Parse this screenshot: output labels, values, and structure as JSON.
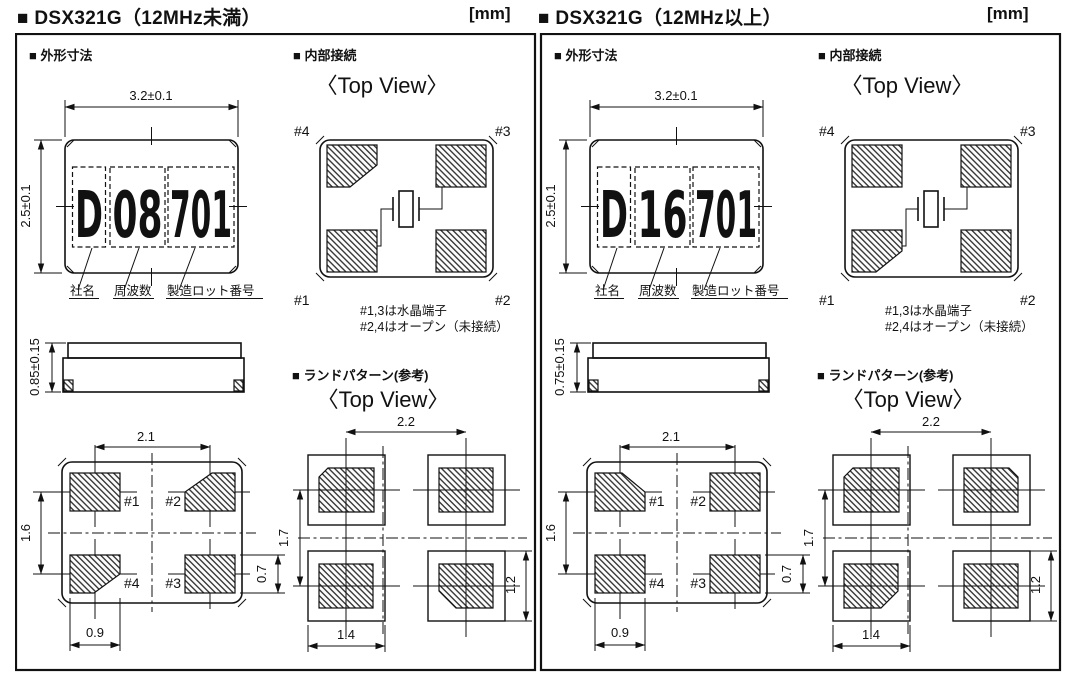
{
  "panels": [
    {
      "title": "■ DSX321G（12MHz未満）",
      "unit": "[mm]",
      "outline": {
        "heading": "■ 外形寸法",
        "dim_width": "3.2±0.1",
        "dim_height": "2.5±0.1",
        "marking": {
          "company": "D",
          "frequency": "08",
          "lot": "701"
        },
        "marking_labels": {
          "company": "社名",
          "frequency": "周波数",
          "lot": "製造ロット番号"
        }
      },
      "side_view": {
        "dim_height": "0.85±0.15"
      },
      "internal": {
        "heading": "■ 内部接続",
        "view_label": "〈Top View〉",
        "pin_top_left": "#4",
        "pin_top_right": "#3",
        "pin_bottom_left": "#1",
        "pin_bottom_right": "#2",
        "note1": "#1,3は水晶端子",
        "note2": "#2,4はオープン（未接続）"
      },
      "bottom_view": {
        "pin_top_left": "#1",
        "pin_top_right": "#2",
        "pin_bottom_left": "#4",
        "pin_bottom_right": "#3",
        "dim_pitch_x": "2.1",
        "dim_pitch_y": "1.6",
        "dim_pad_width": "0.9",
        "dim_pad_height": "0.7"
      },
      "land_pattern": {
        "heading": "■ ランドパターン(参考)",
        "view_label": "〈Top View〉",
        "dim_pitch_x": "2.2",
        "dim_pitch_y": "1.7",
        "dim_pad_width": "1.4",
        "dim_pad_height": "1.2"
      }
    },
    {
      "title": "■ DSX321G（12MHz以上）",
      "unit": "[mm]",
      "outline": {
        "heading": "■ 外形寸法",
        "dim_width": "3.2±0.1",
        "dim_height": "2.5±0.1",
        "marking": {
          "company": "D",
          "frequency": "16",
          "lot": "701"
        },
        "marking_labels": {
          "company": "社名",
          "frequency": "周波数",
          "lot": "製造ロット番号"
        }
      },
      "side_view": {
        "dim_height": "0.75±0.15"
      },
      "internal": {
        "heading": "■ 内部接続",
        "view_label": "〈Top View〉",
        "pin_top_left": "#4",
        "pin_top_right": "#3",
        "pin_bottom_left": "#1",
        "pin_bottom_right": "#2",
        "note1": "#1,3は水晶端子",
        "note2": "#2,4はオープン（未接続）"
      },
      "bottom_view": {
        "pin_top_left": "#1",
        "pin_top_right": "#2",
        "pin_bottom_left": "#4",
        "pin_bottom_right": "#3",
        "dim_pitch_x": "2.1",
        "dim_pitch_y": "1.6",
        "dim_pad_width": "0.9",
        "dim_pad_height": "0.7"
      },
      "land_pattern": {
        "heading": "■ ランドパターン(参考)",
        "view_label": "〈Top View〉",
        "dim_pitch_x": "2.2",
        "dim_pitch_y": "1.7",
        "dim_pad_width": "1.4",
        "dim_pad_height": "1.2"
      }
    }
  ],
  "colors": {
    "ink": "#111111",
    "paper": "#ffffff"
  }
}
